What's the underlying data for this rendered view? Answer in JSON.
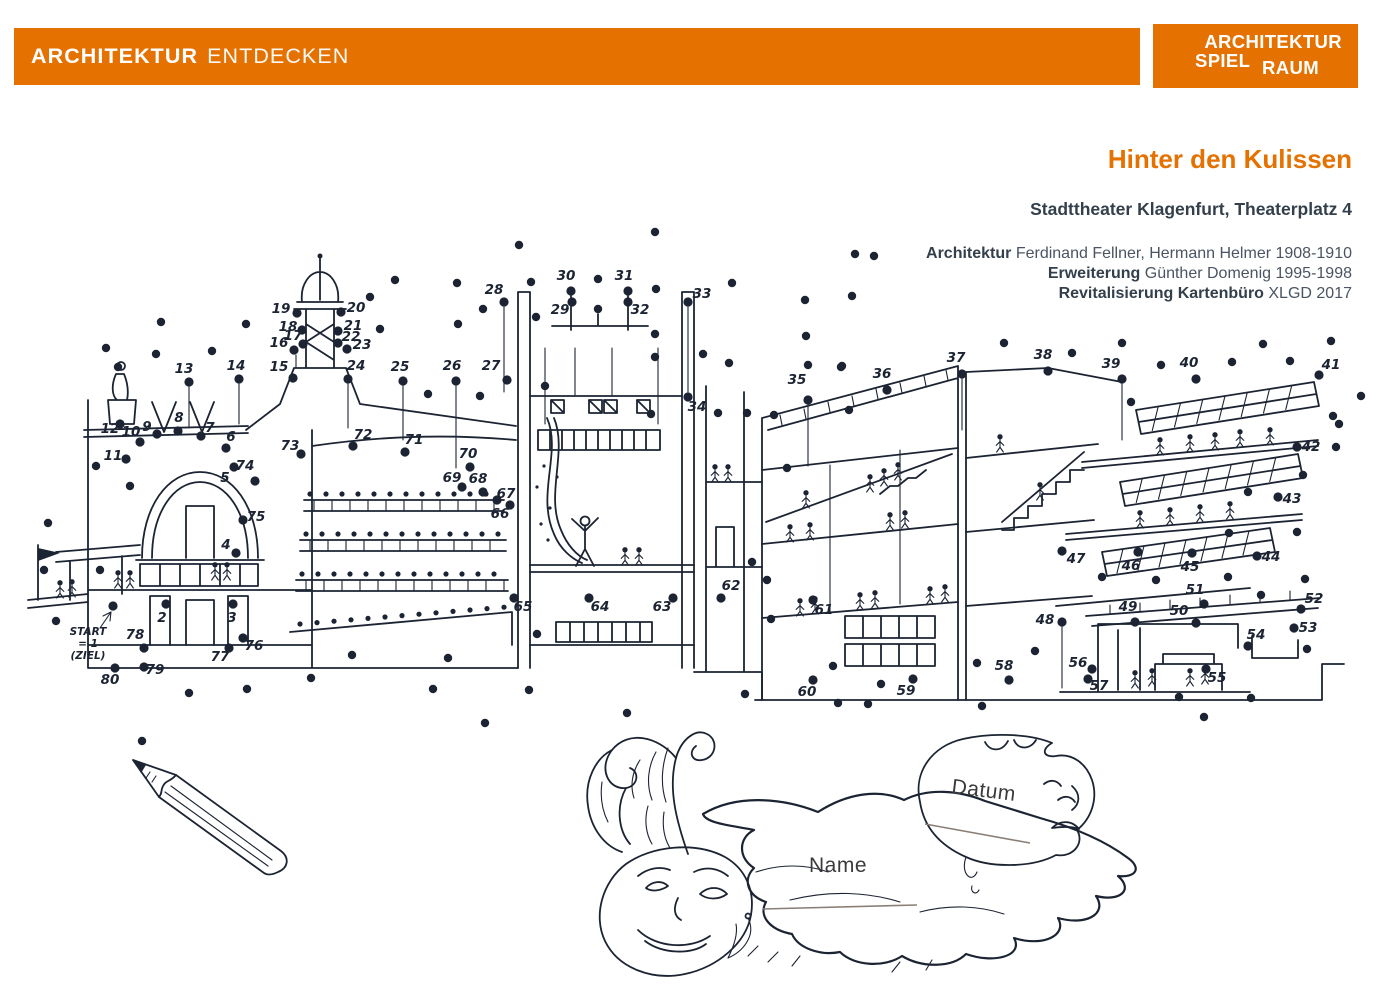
{
  "header": {
    "bar_bold": "ARCHITEKTUR",
    "bar_light": "ENTDECKEN",
    "logo_line1": "ARCHITEKTUR",
    "logo_line2a": "SPIEL",
    "logo_line2b": "RAUM"
  },
  "info": {
    "title": "Hinter den Kulissen",
    "subtitle": "Stadttheater Klagenfurt, Theaterplatz 4",
    "credits": [
      {
        "label": "Architektur",
        "value": " Ferdinand Fellner, Hermann Helmer 1908-1910"
      },
      {
        "label": "Erweiterung",
        "value": " Günther Domenig 1995-1998"
      },
      {
        "label": "Revitalisierung Kartenbüro",
        "value": " XLGD 2017"
      }
    ]
  },
  "form": {
    "name_label": "Name",
    "datum_label": "Datum"
  },
  "colors": {
    "accent": "#E47100",
    "ink": "#1C2433",
    "text": "#3E4852",
    "writing_line": "#8A7F76"
  },
  "puzzle": {
    "start_lines": [
      "START",
      "= 1",
      "(ZIEL)"
    ],
    "numbered_dots": [
      {
        "n": 1,
        "x": 113,
        "y": 606,
        "lx": null,
        "ly": null
      },
      {
        "n": 2,
        "x": 166,
        "y": 604,
        "lx": 162,
        "ly": 622
      },
      {
        "n": 3,
        "x": 233,
        "y": 604,
        "lx": 232,
        "ly": 622
      },
      {
        "n": 4,
        "x": 236,
        "y": 553,
        "lx": 226,
        "ly": 549
      },
      {
        "n": 5,
        "x": 234,
        "y": 467,
        "lx": 225,
        "ly": 482
      },
      {
        "n": 6,
        "x": 226,
        "y": 448,
        "lx": 231,
        "ly": 441
      },
      {
        "n": 7,
        "x": 201,
        "y": 436,
        "lx": 210,
        "ly": 432
      },
      {
        "n": 8,
        "x": 178,
        "y": 431,
        "lx": 179,
        "ly": 422
      },
      {
        "n": 9,
        "x": 157,
        "y": 434,
        "lx": 147,
        "ly": 431
      },
      {
        "n": 10,
        "x": 140,
        "y": 442,
        "lx": 131,
        "ly": 436
      },
      {
        "n": 11,
        "x": 126,
        "y": 459,
        "lx": 113,
        "ly": 460
      },
      {
        "n": 12,
        "x": 120,
        "y": 424,
        "lx": 110,
        "ly": 433
      },
      {
        "n": 13,
        "x": 189,
        "y": 382,
        "lx": 184,
        "ly": 373
      },
      {
        "n": 14,
        "x": 239,
        "y": 379,
        "lx": 236,
        "ly": 370
      },
      {
        "n": 15,
        "x": 293,
        "y": 378,
        "lx": 279,
        "ly": 371
      },
      {
        "n": 16,
        "x": 294,
        "y": 350,
        "lx": 279,
        "ly": 347
      },
      {
        "n": 17,
        "x": 303,
        "y": 344,
        "lx": 293,
        "ly": 340
      },
      {
        "n": 18,
        "x": 302,
        "y": 330,
        "lx": 288,
        "ly": 331
      },
      {
        "n": 19,
        "x": 297,
        "y": 313,
        "lx": 281,
        "ly": 313
      },
      {
        "n": 20,
        "x": 341,
        "y": 312,
        "lx": 356,
        "ly": 312
      },
      {
        "n": 21,
        "x": 338,
        "y": 331,
        "lx": 353,
        "ly": 330
      },
      {
        "n": 22,
        "x": 338,
        "y": 343,
        "lx": 351,
        "ly": 341
      },
      {
        "n": 23,
        "x": 347,
        "y": 349,
        "lx": 362,
        "ly": 349
      },
      {
        "n": 24,
        "x": 348,
        "y": 379,
        "lx": 356,
        "ly": 370
      },
      {
        "n": 25,
        "x": 403,
        "y": 381,
        "lx": 400,
        "ly": 371
      },
      {
        "n": 26,
        "x": 456,
        "y": 381,
        "lx": 452,
        "ly": 370
      },
      {
        "n": 27,
        "x": 507,
        "y": 380,
        "lx": 491,
        "ly": 370
      },
      {
        "n": 28,
        "x": 504,
        "y": 302,
        "lx": 494,
        "ly": 294
      },
      {
        "n": 29,
        "x": 572,
        "y": 302,
        "lx": 560,
        "ly": 314
      },
      {
        "n": 30,
        "x": 571,
        "y": 291,
        "lx": 566,
        "ly": 280
      },
      {
        "n": 31,
        "x": 628,
        "y": 291,
        "lx": 624,
        "ly": 280
      },
      {
        "n": 32,
        "x": 628,
        "y": 302,
        "lx": 640,
        "ly": 314
      },
      {
        "n": 33,
        "x": 688,
        "y": 302,
        "lx": 702,
        "ly": 298
      },
      {
        "n": 34,
        "x": 688,
        "y": 397,
        "lx": 697,
        "ly": 411
      },
      {
        "n": 35,
        "x": 808,
        "y": 400,
        "lx": 797,
        "ly": 384
      },
      {
        "n": 36,
        "x": 887,
        "y": 390,
        "lx": 882,
        "ly": 378
      },
      {
        "n": 37,
        "x": 962,
        "y": 374,
        "lx": 956,
        "ly": 362
      },
      {
        "n": 38,
        "x": 1048,
        "y": 371,
        "lx": 1043,
        "ly": 359
      },
      {
        "n": 39,
        "x": 1122,
        "y": 379,
        "lx": 1111,
        "ly": 368
      },
      {
        "n": 40,
        "x": 1196,
        "y": 379,
        "lx": 1189,
        "ly": 367
      },
      {
        "n": 41,
        "x": 1319,
        "y": 375,
        "lx": 1331,
        "ly": 369
      },
      {
        "n": 42,
        "x": 1297,
        "y": 447,
        "lx": 1311,
        "ly": 451
      },
      {
        "n": 43,
        "x": 1278,
        "y": 497,
        "lx": 1292,
        "ly": 503
      },
      {
        "n": 44,
        "x": 1257,
        "y": 556,
        "lx": 1271,
        "ly": 561
      },
      {
        "n": 45,
        "x": 1192,
        "y": 553,
        "lx": 1190,
        "ly": 571
      },
      {
        "n": 46,
        "x": 1138,
        "y": 552,
        "lx": 1131,
        "ly": 570
      },
      {
        "n": 47,
        "x": 1062,
        "y": 551,
        "lx": 1076,
        "ly": 563
      },
      {
        "n": 48,
        "x": 1062,
        "y": 622,
        "lx": 1045,
        "ly": 624
      },
      {
        "n": 49,
        "x": 1135,
        "y": 622,
        "lx": 1128,
        "ly": 611
      },
      {
        "n": 50,
        "x": 1196,
        "y": 623,
        "lx": 1179,
        "ly": 615
      },
      {
        "n": 51,
        "x": 1204,
        "y": 604,
        "lx": 1195,
        "ly": 594
      },
      {
        "n": 52,
        "x": 1301,
        "y": 609,
        "lx": 1314,
        "ly": 603
      },
      {
        "n": 53,
        "x": 1294,
        "y": 628,
        "lx": 1308,
        "ly": 632
      },
      {
        "n": 54,
        "x": 1248,
        "y": 646,
        "lx": 1256,
        "ly": 639
      },
      {
        "n": 55,
        "x": 1206,
        "y": 669,
        "lx": 1217,
        "ly": 682
      },
      {
        "n": 56,
        "x": 1092,
        "y": 669,
        "lx": 1078,
        "ly": 667
      },
      {
        "n": 57,
        "x": 1088,
        "y": 679,
        "lx": 1099,
        "ly": 690
      },
      {
        "n": 58,
        "x": 1009,
        "y": 680,
        "lx": 1004,
        "ly": 670
      },
      {
        "n": 59,
        "x": 913,
        "y": 679,
        "lx": 906,
        "ly": 695
      },
      {
        "n": 60,
        "x": 813,
        "y": 680,
        "lx": 807,
        "ly": 696
      },
      {
        "n": 61,
        "x": 813,
        "y": 600,
        "lx": 824,
        "ly": 614
      },
      {
        "n": 62,
        "x": 721,
        "y": 598,
        "lx": 731,
        "ly": 590
      },
      {
        "n": 63,
        "x": 673,
        "y": 598,
        "lx": 662,
        "ly": 611
      },
      {
        "n": 64,
        "x": 589,
        "y": 598,
        "lx": 600,
        "ly": 611
      },
      {
        "n": 65,
        "x": 514,
        "y": 598,
        "lx": 523,
        "ly": 611
      },
      {
        "n": 66,
        "x": 510,
        "y": 505,
        "lx": 500,
        "ly": 518
      },
      {
        "n": 67,
        "x": 497,
        "y": 500,
        "lx": 506,
        "ly": 498
      },
      {
        "n": 68,
        "x": 483,
        "y": 492,
        "lx": 478,
        "ly": 483
      },
      {
        "n": 69,
        "x": 462,
        "y": 487,
        "lx": 452,
        "ly": 482
      },
      {
        "n": 70,
        "x": 470,
        "y": 467,
        "lx": 468,
        "ly": 458
      },
      {
        "n": 71,
        "x": 405,
        "y": 452,
        "lx": 414,
        "ly": 444
      },
      {
        "n": 72,
        "x": 353,
        "y": 446,
        "lx": 363,
        "ly": 439
      },
      {
        "n": 73,
        "x": 301,
        "y": 454,
        "lx": 290,
        "ly": 450
      },
      {
        "n": 74,
        "x": 255,
        "y": 481,
        "lx": 245,
        "ly": 470
      },
      {
        "n": 75,
        "x": 243,
        "y": 520,
        "lx": 256,
        "ly": 521
      },
      {
        "n": 76,
        "x": 243,
        "y": 638,
        "lx": 254,
        "ly": 650
      },
      {
        "n": 77,
        "x": 229,
        "y": 648,
        "lx": 220,
        "ly": 661
      },
      {
        "n": 78,
        "x": 144,
        "y": 648,
        "lx": 135,
        "ly": 639
      },
      {
        "n": 79,
        "x": 144,
        "y": 667,
        "lx": 155,
        "ly": 674
      },
      {
        "n": 80,
        "x": 115,
        "y": 668,
        "lx": 110,
        "ly": 684
      }
    ],
    "scatter_dots": [
      [
        161,
        322
      ],
      [
        246,
        324
      ],
      [
        106,
        348
      ],
      [
        156,
        354
      ],
      [
        212,
        351
      ],
      [
        118,
        367
      ],
      [
        96,
        466
      ],
      [
        130,
        486
      ],
      [
        48,
        523
      ],
      [
        44,
        570
      ],
      [
        100,
        570
      ],
      [
        56,
        621
      ],
      [
        189,
        693
      ],
      [
        247,
        689
      ],
      [
        311,
        678
      ],
      [
        352,
        655
      ],
      [
        433,
        689
      ],
      [
        448,
        658
      ],
      [
        529,
        690
      ],
      [
        537,
        634
      ],
      [
        485,
        723
      ],
      [
        142,
        741
      ],
      [
        627,
        713
      ],
      [
        838,
        703
      ],
      [
        868,
        704
      ],
      [
        982,
        706
      ],
      [
        1204,
        717
      ],
      [
        745,
        694
      ],
      [
        881,
        684
      ],
      [
        833,
        666
      ],
      [
        771,
        619
      ],
      [
        767,
        580
      ],
      [
        752,
        562
      ],
      [
        977,
        663
      ],
      [
        1035,
        651
      ],
      [
        1179,
        697
      ],
      [
        1251,
        698
      ],
      [
        1261,
        595
      ],
      [
        1307,
        649
      ],
      [
        655,
        232
      ],
      [
        519,
        245
      ],
      [
        874,
        256
      ],
      [
        855,
        254
      ],
      [
        395,
        280
      ],
      [
        457,
        283
      ],
      [
        531,
        282
      ],
      [
        598,
        279
      ],
      [
        732,
        283
      ],
      [
        805,
        300
      ],
      [
        852,
        296
      ],
      [
        370,
        297
      ],
      [
        483,
        309
      ],
      [
        380,
        329
      ],
      [
        458,
        324
      ],
      [
        536,
        317
      ],
      [
        598,
        309
      ],
      [
        656,
        289
      ],
      [
        655,
        334
      ],
      [
        655,
        357
      ],
      [
        703,
        354
      ],
      [
        729,
        363
      ],
      [
        806,
        336
      ],
      [
        808,
        365
      ],
      [
        841,
        367
      ],
      [
        428,
        394
      ],
      [
        480,
        396
      ],
      [
        545,
        386
      ],
      [
        718,
        413
      ],
      [
        747,
        413
      ],
      [
        774,
        415
      ],
      [
        651,
        414
      ],
      [
        849,
        410
      ],
      [
        787,
        468
      ],
      [
        1004,
        343
      ],
      [
        1072,
        353
      ],
      [
        842,
        366
      ],
      [
        1122,
        343
      ],
      [
        1263,
        344
      ],
      [
        1331,
        341
      ],
      [
        1232,
        362
      ],
      [
        1290,
        361
      ],
      [
        1161,
        365
      ],
      [
        1131,
        402
      ],
      [
        1333,
        416
      ],
      [
        1336,
        447
      ],
      [
        1303,
        475
      ],
      [
        1248,
        492
      ],
      [
        1297,
        532
      ],
      [
        1229,
        533
      ],
      [
        1102,
        577
      ],
      [
        1156,
        580
      ],
      [
        1228,
        577
      ],
      [
        1305,
        579
      ],
      [
        1339,
        424
      ],
      [
        1361,
        396
      ]
    ]
  }
}
